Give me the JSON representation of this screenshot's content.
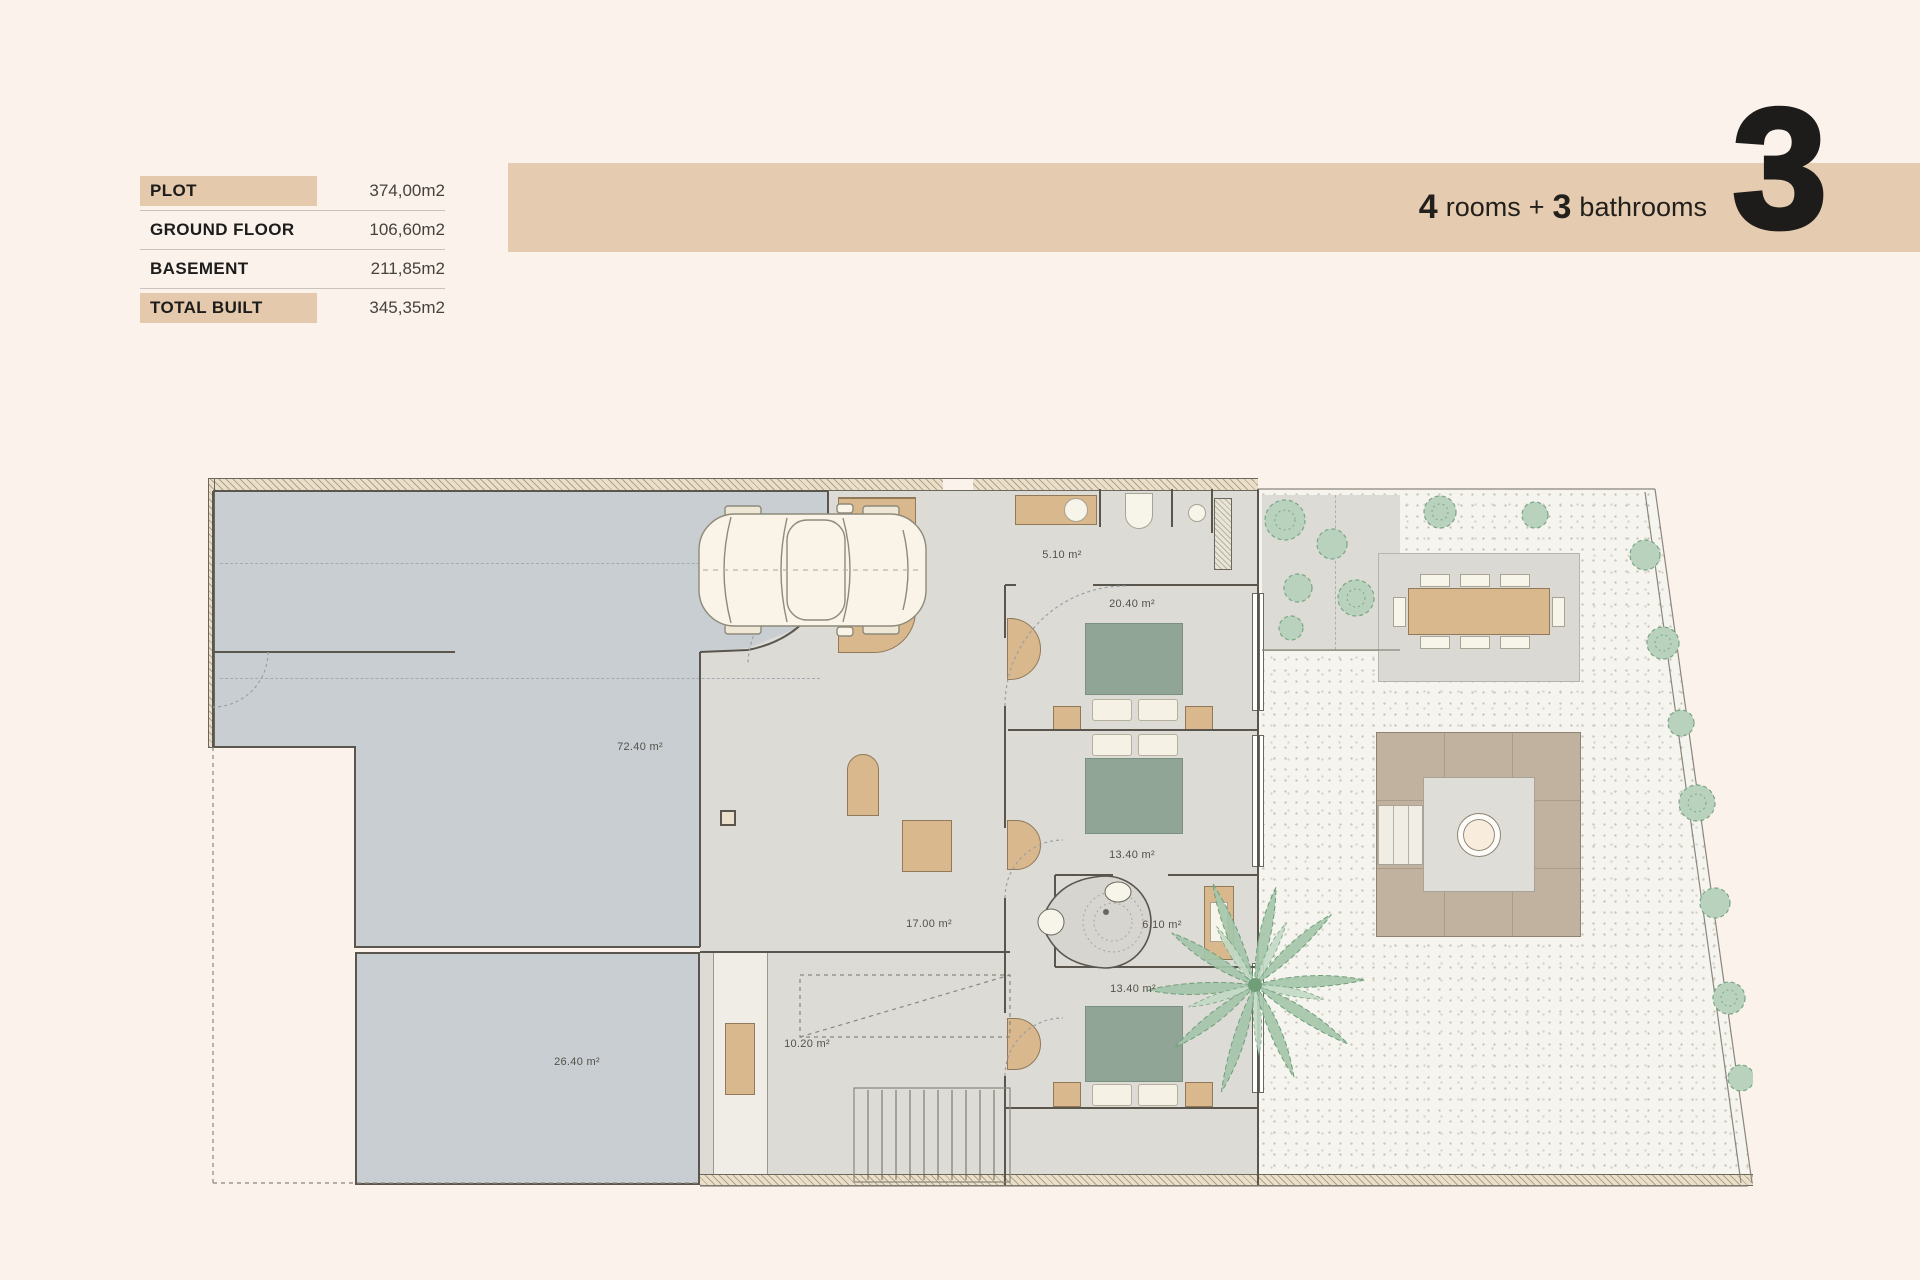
{
  "header": {
    "specs": [
      {
        "label": "PLOT",
        "value": "374,00m2"
      },
      {
        "label": "GROUND FLOOR",
        "value": "106,60m2"
      },
      {
        "label": "BASEMENT",
        "value": "211,85m2"
      },
      {
        "label": "TOTAL BUILT",
        "value": "345,35m2"
      }
    ],
    "banner": {
      "rooms_count": "4",
      "rooms_label": "rooms",
      "plus": "+",
      "bathrooms_count": "3",
      "bathrooms_label": "bathrooms",
      "unit_number": "3"
    }
  },
  "floor_plan": {
    "rooms": [
      {
        "name": "driveway-garage",
        "area_label": "72.40 m²"
      },
      {
        "name": "storage-room",
        "area_label": "26.40 m²"
      },
      {
        "name": "hallway",
        "area_label": "17.00 m²"
      },
      {
        "name": "staircase",
        "area_label": "10.20 m²"
      },
      {
        "name": "bathroom-top",
        "area_label": "5.10 m²"
      },
      {
        "name": "bedroom-main",
        "area_label": "20.40 m²"
      },
      {
        "name": "bedroom-2",
        "area_label": "13.40 m²"
      },
      {
        "name": "bathroom-middle",
        "area_label": "6.10 m²"
      },
      {
        "name": "bedroom-3",
        "area_label": "13.40 m²"
      }
    ],
    "colors": {
      "background": "#fbf2eb",
      "accent_tan": "#e5cbaf",
      "driveway_gray": "#c9ced3",
      "interior_floor": "#dcdbd6",
      "wood": "#d9b88e",
      "bed_green": "#91a596",
      "plant_green": "#a4c5aa",
      "text_dark": "#1d1c1a"
    }
  }
}
